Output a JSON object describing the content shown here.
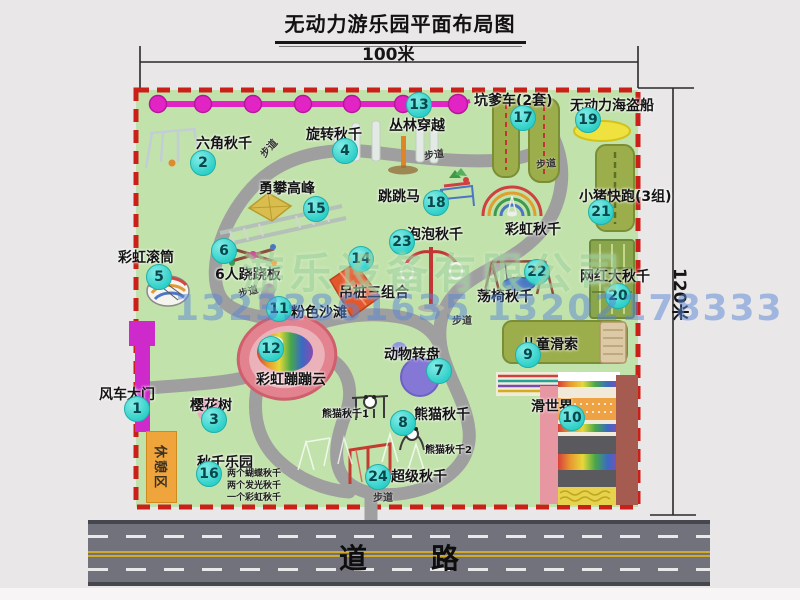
{
  "title": "无动力游乐园平面布局图",
  "dimensions": {
    "top": "100米",
    "right": "120米"
  },
  "road": {
    "label": "道路"
  },
  "watermarks": {
    "company": "游乐设备有限公司",
    "phone": "13233861635 13202178333"
  },
  "rest_area": "休憩区",
  "path_label": "步道",
  "attractions": [
    {
      "num": "1",
      "name": "风车大门"
    },
    {
      "num": "2",
      "name": "六角秋千"
    },
    {
      "num": "3",
      "name": "樱花树"
    },
    {
      "num": "4",
      "name": "旋转秋千"
    },
    {
      "num": "5",
      "name": "彩虹滚筒"
    },
    {
      "num": "6",
      "name": "6人跷跷板"
    },
    {
      "num": "7",
      "name": "动物转盘"
    },
    {
      "num": "8",
      "name": "熊猫秋千"
    },
    {
      "num": "9",
      "name": "儿童滑索"
    },
    {
      "num": "10",
      "name": "滑世界"
    },
    {
      "num": "11",
      "name": "粉色沙滩"
    },
    {
      "num": "12",
      "name": "彩虹蹦蹦云"
    },
    {
      "num": "13",
      "name": "丛林穿越"
    },
    {
      "num": "14",
      "name": "吊桩三组合"
    },
    {
      "num": "15",
      "name": "勇攀高峰"
    },
    {
      "num": "16",
      "name": "秋千乐园"
    },
    {
      "num": "17",
      "name": "坑爹车(2套)"
    },
    {
      "num": "18",
      "name": "跳跳马"
    },
    {
      "num": "19",
      "name": "无动力海盗船"
    },
    {
      "num": "20",
      "name": "网红大秋千"
    },
    {
      "num": "21",
      "name": "小猪快跑(3组)"
    },
    {
      "num": "22",
      "name": "荡椅秋千"
    },
    {
      "num": "23",
      "name": "泡泡秋千"
    },
    {
      "num": "24",
      "name": "超级秋千"
    }
  ],
  "extra_labels": {
    "rainbow_swing": "彩虹秋千",
    "panda_swing_1": "熊猫秋千1",
    "panda_swing_2": "熊猫秋千2"
  },
  "swing_park_notes": [
    "两个蝴蝶秋千",
    "两个发光秋千",
    "一个彩虹秋千"
  ],
  "colors": {
    "badge": "#2fd0c9",
    "boundary_red": "#cb1f1a",
    "park_green": "#c2e2ab",
    "chain_magenta": "#e324c4",
    "road_gray": "#72727c",
    "watermark_green": "#92cc92",
    "watermark_blue": "#5886d6"
  }
}
